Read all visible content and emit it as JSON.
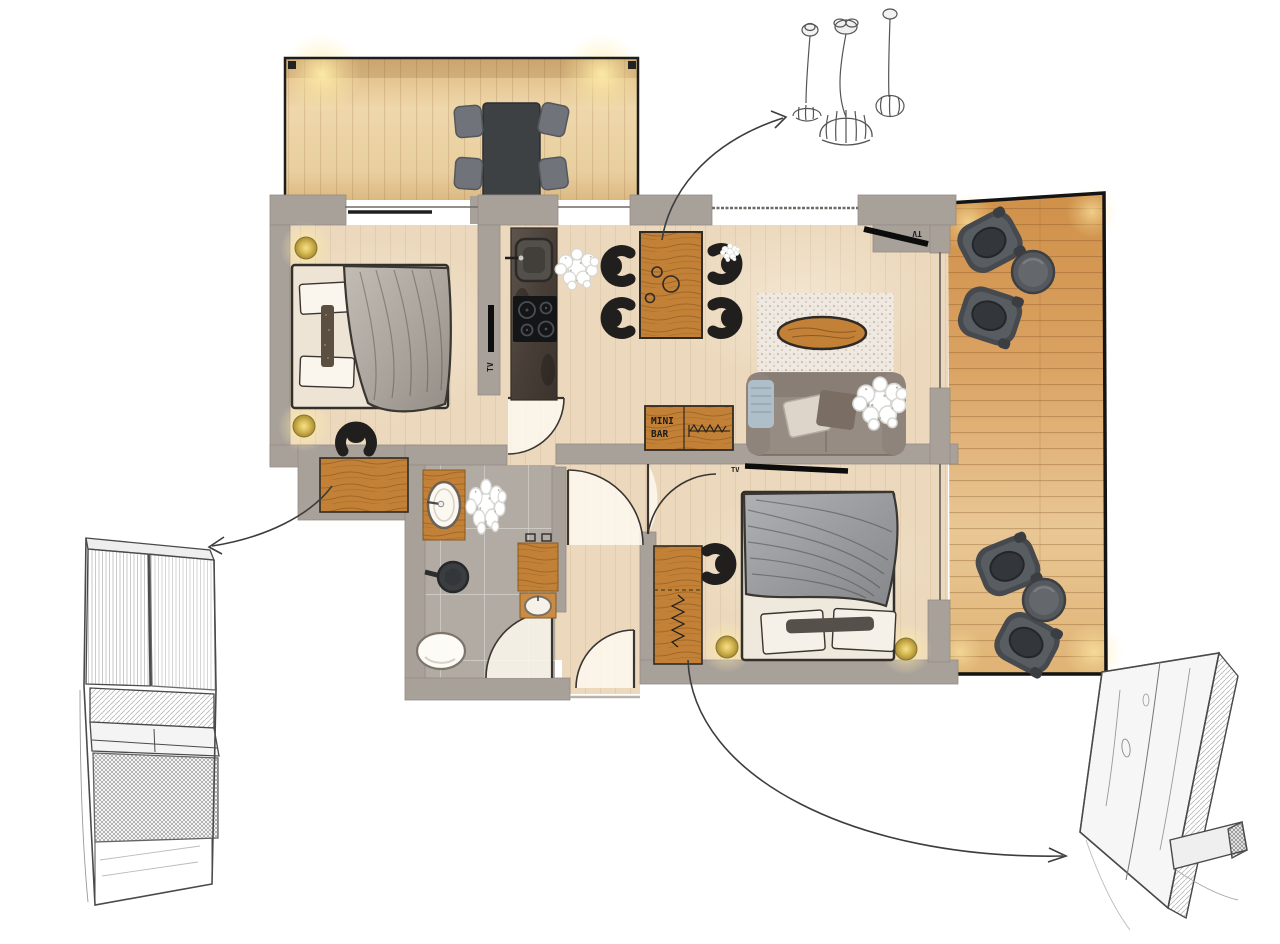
{
  "plan": {
    "labels": {
      "minibar_top": "MINI",
      "minibar_bottom": "BAR",
      "tv_bedroom1": "TV",
      "tv_living": "TV",
      "tv_bedroom2": "TV"
    },
    "colors": {
      "wall_gray": "#a8a19a",
      "interior_floor": "#ecd9bd",
      "terrace_wood": "#d99f5c",
      "deck_wood": "#e8d0a4",
      "bath_tile": "#b2aba3",
      "furniture_wood": "#c28136",
      "dark_furniture": "#3e4144",
      "lamp_gold": "#d9bb55",
      "sketch_pencil": "#4a4a4a"
    }
  }
}
